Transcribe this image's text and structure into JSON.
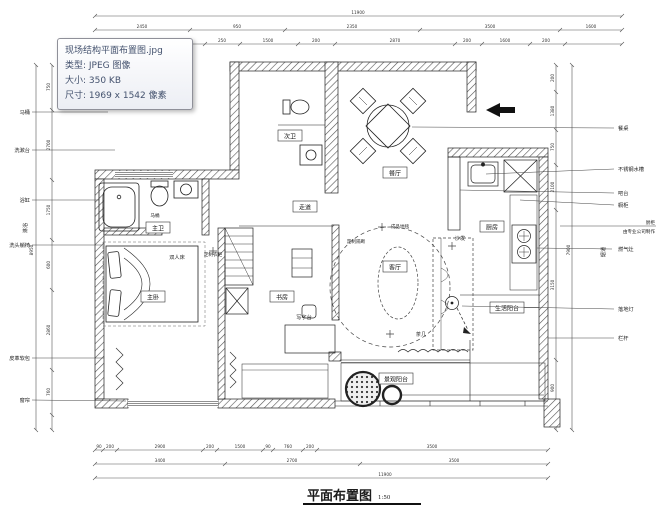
{
  "tooltip": {
    "filename": "现场结构平面布置图.jpg",
    "type": "类型: JPEG 图像",
    "size": "大小: 350 KB",
    "dimensions": "尺寸: 1969 x 1542 像素"
  },
  "title": {
    "text": "平面布置图",
    "scale": "1:50"
  },
  "rooms": {
    "master_bath": "主卫",
    "master_bedroom": "主卧",
    "second_bath": "次卫",
    "corridor": "走道",
    "dining": "餐厅",
    "living": "客厅",
    "study": "书房",
    "kitchen": "厨房",
    "service_balcony": "生活阳台",
    "view_balcony": "景观阳台"
  },
  "labels": {
    "toilet_inside": "马桶",
    "double_bed": "双人床",
    "custom_wardrobe": "定制衣柜",
    "custom_partition": "定制隔断",
    "finished_rug": "成品地毯",
    "sofa": "沙发",
    "tea_table": "茶几",
    "writing_desk": "写字台"
  },
  "left_annotations": {
    "toilet": "马桶",
    "washstand": "洗漱台",
    "bathtub": "浴缸",
    "shower": "淋浴",
    "hair_wash_chair": "洗头躺椅",
    "leather_padding": "皮革软包",
    "curtain": "窗帘"
  },
  "right_annotations": {
    "dining_table": "餐桌",
    "stainless_sink": "不锈钢水槽",
    "bar_counter": "吧台",
    "cabinet": "橱柜",
    "note_line1": "厨柜",
    "note_line2": "由专业公司制作",
    "gas_stove": "燃气灶",
    "flue": "烟道",
    "floor_lamp": "落地灯",
    "railing": "栏杆"
  },
  "dimensions": {
    "top_overall": "11900",
    "top_tier2": [
      "2450",
      "950",
      "2350",
      "3500",
      "1600"
    ],
    "top_tier3": [
      "1350",
      "950",
      "250",
      "1500",
      "200",
      "2870",
      "200",
      "1600",
      "200"
    ],
    "bottom_tier1": [
      "90",
      "200",
      "2900",
      "200",
      "1500",
      "90",
      "760",
      "200",
      "3500"
    ],
    "bottom_tier2": [
      "3400",
      "2700",
      "3500"
    ],
    "bottom_overall": "11900",
    "left_tier": [
      "750",
      "2700",
      "1750",
      "600",
      "2860",
      "760"
    ],
    "left_overall": "8950",
    "right_tier": [
      "200",
      "1380",
      "750",
      "2100",
      "3150",
      "900"
    ],
    "right_overall": "7900"
  }
}
